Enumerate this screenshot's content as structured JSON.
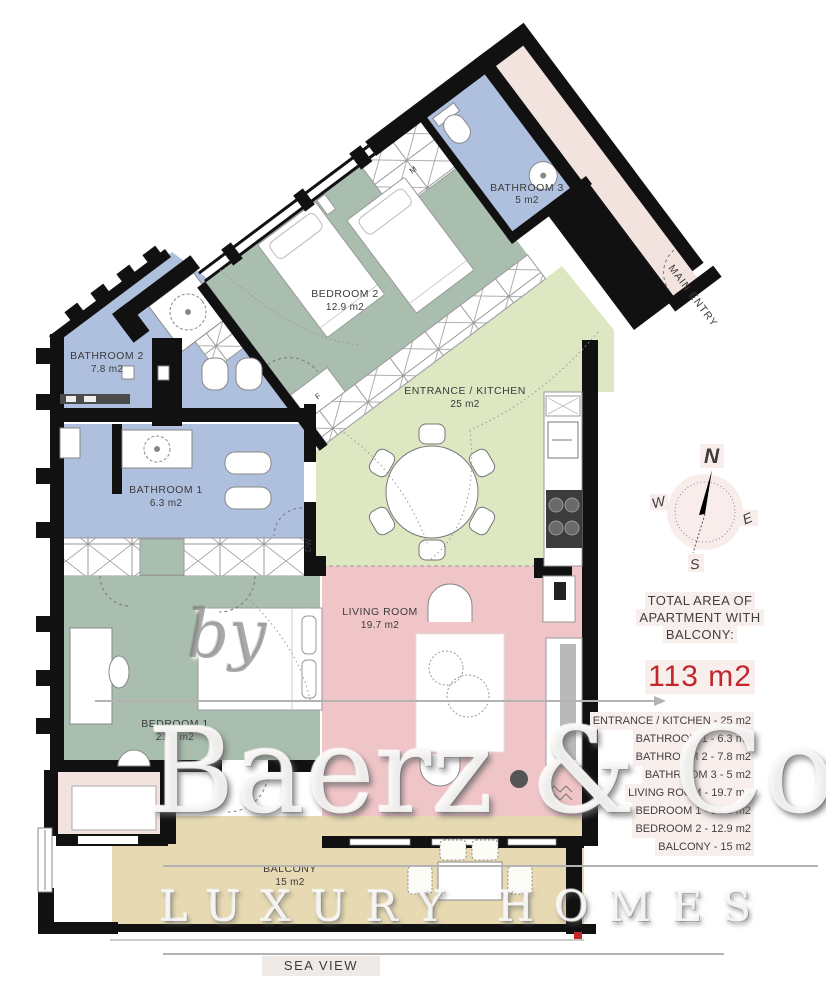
{
  "plan": {
    "rooms": [
      {
        "name": "BEDROOM 2",
        "area": "12.9 m2"
      },
      {
        "name": "BATHROOM 3",
        "area": "5 m2"
      },
      {
        "name": "BATHROOM 2",
        "area": "7.8 m2"
      },
      {
        "name": "BATHROOM 1",
        "area": "6.3 m2"
      },
      {
        "name": "ENTRANCE / KITCHEN",
        "area": "25 m2"
      },
      {
        "name": "LIVING ROOM",
        "area": "19.7 m2"
      },
      {
        "name": "BEDROOM 1",
        "area": "21.3 m2"
      },
      {
        "name": "BALCONY",
        "area": "15 m2"
      }
    ],
    "annotations": {
      "main_entry": "MAIN ENTRY",
      "sea_view": "SEA VIEW",
      "dishwasher": "DW",
      "fridge": "F",
      "washer": "M"
    }
  },
  "compass": {
    "north": "N",
    "east": "E",
    "south": "S",
    "west": "W"
  },
  "summary": {
    "title_lines": [
      "TOTAL AREA OF",
      "APARTMENT WITH",
      "BALCONY:"
    ],
    "total_area": "113 m2",
    "items": [
      "ENTRANCE / KITCHEN - 25 m2",
      "BATHROOM 1 - 6.3 m2",
      "BATHROOM 2 - 7.8 m2",
      "BATHROOM 3 - 5 m2",
      "LIVING ROOM - 19.7 m2",
      "BEDROOM 1 - 21.3 m2",
      "BEDROOM 2 - 12.9 m2",
      "BALCONY - 15 m2"
    ]
  },
  "watermark": {
    "prefix": "by",
    "brand": "Baerz & Co",
    "tagline": "LUXURY HOMES"
  },
  "colors": {
    "bedroom_green": "#a9beae",
    "bathroom_blue": "#afc0df",
    "kitchen_green": "#dde7c2",
    "living_pink": "#f0c5c8",
    "balcony_tan": "#e7dab2",
    "hall_cream": "#f3e3de",
    "wall_black": "#111111",
    "accent_red": "#c1272d",
    "label_gray": "#3b3b3b",
    "watermark_gray": "#b3b3b3",
    "compass_bg": "#f8edeb"
  }
}
